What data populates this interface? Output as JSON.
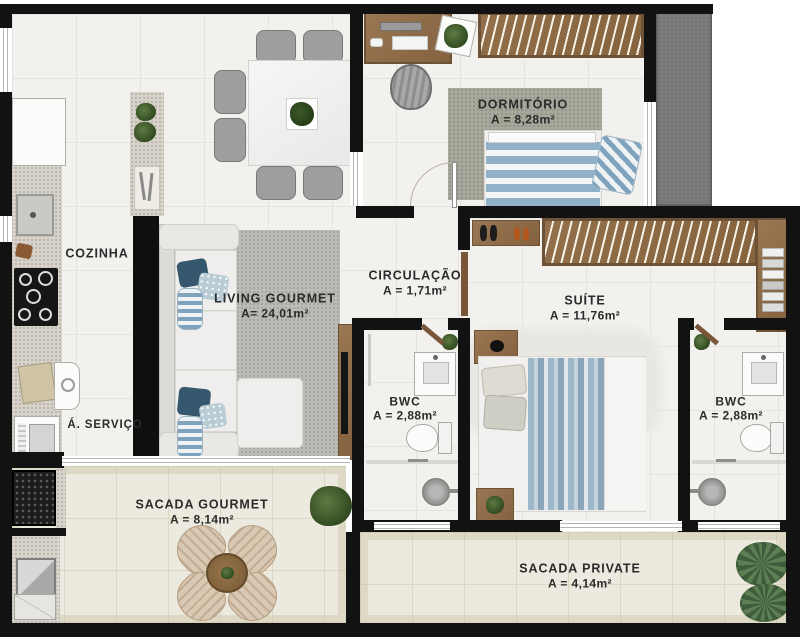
{
  "title": "Apartment floor plan",
  "rooms": {
    "cozinha": {
      "name": "COZINHA"
    },
    "servico": {
      "name": "Á. SERVIÇO"
    },
    "dormitorio": {
      "name": "DORMITÓRIO",
      "area": "A = 8,28m²"
    },
    "circulacao": {
      "name": "CIRCULAÇÃO",
      "area": "A = 1,71m²"
    },
    "living": {
      "name": "LIVING GOURMET",
      "area": "A= 24,01m²"
    },
    "suite": {
      "name": "SUÍTE",
      "area": "A = 11,76m²"
    },
    "bwc1": {
      "name": "BWC",
      "area": "A = 2,88m²"
    },
    "bwc2": {
      "name": "BWC",
      "area": "A = 2,88m²"
    },
    "sacada_gourmet": {
      "name": "SACADA GOURMET",
      "area": "A = 8,14m²"
    },
    "sacada_private": {
      "name": "SACADA PRIVATE",
      "area": "A = 4,14m²"
    }
  },
  "colors": {
    "wall": "#121212",
    "floor_tile": "#f2f1ee",
    "balcony_floor": "#eceade",
    "wood": "#8d6c4a",
    "rug_living": "#bcbcb9",
    "rug_dormitorio": "#a6a89a",
    "accent_blue": "#8fb2c8",
    "corridor_gray": "#7c7c7c",
    "label_text": "#2b2b2b"
  }
}
